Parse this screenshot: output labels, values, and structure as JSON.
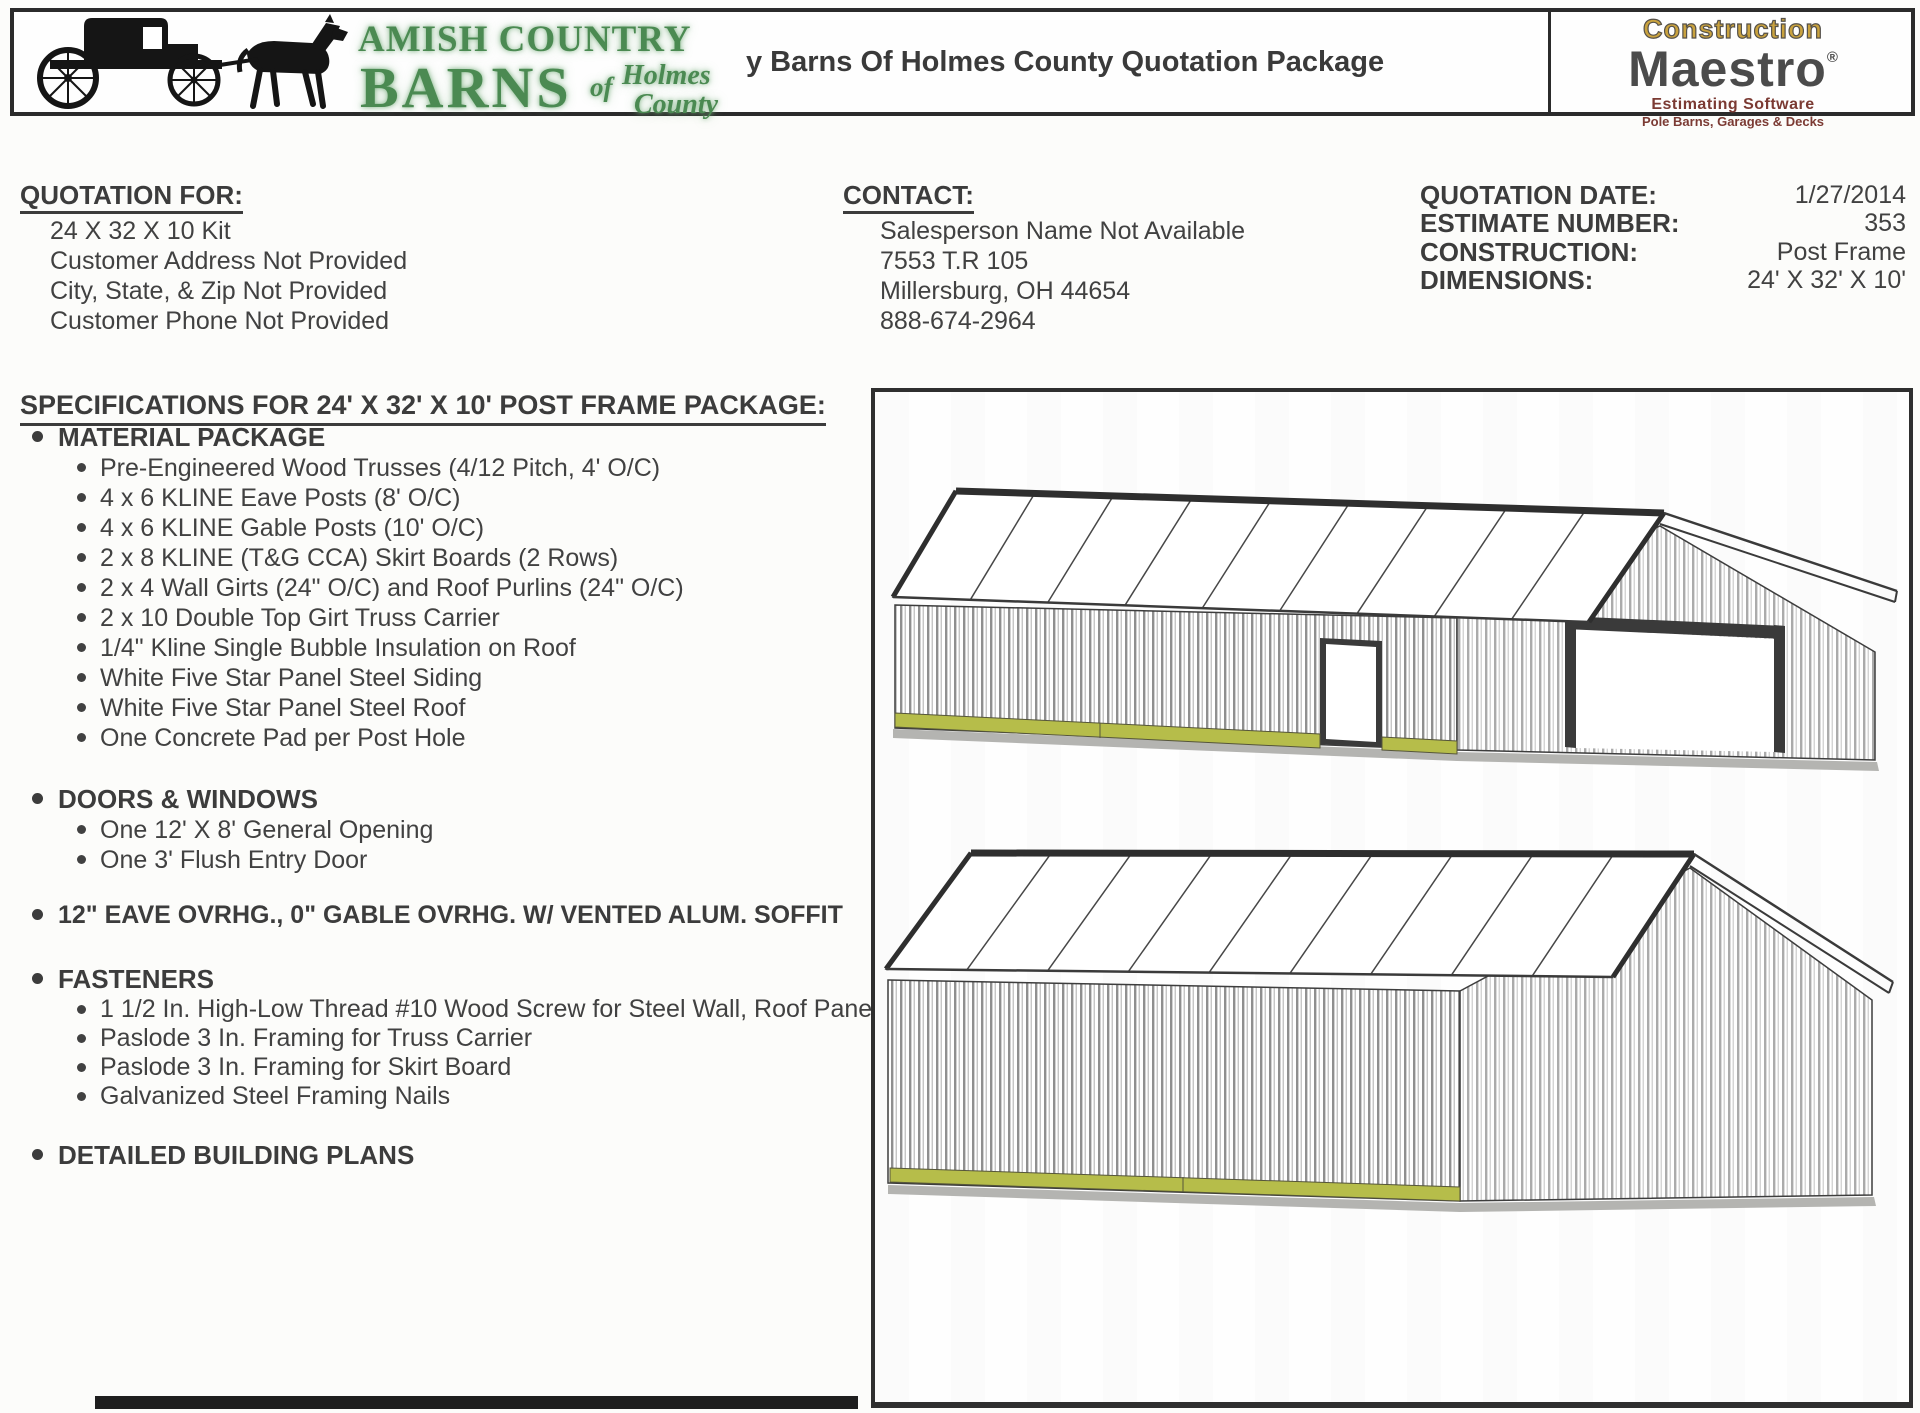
{
  "header": {
    "title": "y Barns Of Holmes County Quotation Package",
    "logo": {
      "line1": "AMISH COUNTRY",
      "line2": "BARNS",
      "word_of": "of",
      "word_holmes": "Holmes",
      "word_county": "County"
    },
    "maestro": {
      "line1": "Construction",
      "line2": "Maestro",
      "registered": "®",
      "line3": "Estimating Software",
      "line4": "Pole Barns, Garages & Decks"
    },
    "colors": {
      "logo_green": "#4b8a52",
      "maestro_gold": "#c9a23e",
      "maestro_gray": "#4b4b4b",
      "maestro_maroon": "#7b3a33"
    }
  },
  "quotation_for": {
    "heading": "QUOTATION FOR:",
    "lines": [
      "24 X 32 X 10 Kit",
      "Customer Address Not Provided",
      "City, State, & Zip Not Provided",
      "Customer Phone Not Provided"
    ]
  },
  "contact": {
    "heading": "CONTACT:",
    "lines": [
      "Salesperson Name Not Available",
      "7553 T.R 105",
      "Millersburg, OH 44654",
      "888-674-2964"
    ]
  },
  "details": {
    "rows": [
      {
        "label": "QUOTATION DATE:",
        "value": "1/27/2014"
      },
      {
        "label": "ESTIMATE NUMBER:",
        "value": "353"
      },
      {
        "label": "CONSTRUCTION:",
        "value": "Post Frame"
      },
      {
        "label": "DIMENSIONS:",
        "value": "24' X 32' X 10'"
      }
    ]
  },
  "specifications": {
    "heading": "SPECIFICATIONS FOR 24' X 32' X 10' POST FRAME PACKAGE:",
    "material": {
      "heading": "MATERIAL PACKAGE",
      "items": [
        "Pre-Engineered Wood Trusses (4/12 Pitch, 4' O/C)",
        "4 x 6 KLINE Eave Posts (8' O/C)",
        "4 x 6 KLINE Gable Posts (10' O/C)",
        "2 x 8 KLINE (T&G CCA) Skirt Boards (2 Rows)",
        "2 x 4 Wall Girts (24\" O/C) and Roof Purlins (24\" O/C)",
        "2 x 10 Double Top Girt Truss Carrier",
        "1/4\" Kline Single Bubble Insulation on Roof",
        "White Five Star Panel Steel Siding",
        "White Five Star Panel Steel Roof",
        "One Concrete Pad per Post Hole"
      ]
    },
    "doors": {
      "heading": "DOORS & WINDOWS",
      "items": [
        "One 12' X 8' General Opening",
        "One 3' Flush Entry Door"
      ]
    },
    "overhang": "12\" EAVE OVRHG., 0\" GABLE OVRHG. W/ VENTED ALUM. SOFFIT",
    "fasteners": {
      "heading": "FASTENERS",
      "items": [
        "1 1/2 In. High-Low Thread #10 Wood Screw for Steel Wall, Roof Pane",
        "Paslode 3 In. Framing for Truss Carrier",
        "Paslode 3 In. Framing for Skirt Board",
        "Galvanized Steel Framing Nails"
      ]
    },
    "plans": "DETAILED BUILDING PLANS"
  },
  "drawing": {
    "skirt_color": "#b6bd4a"
  }
}
